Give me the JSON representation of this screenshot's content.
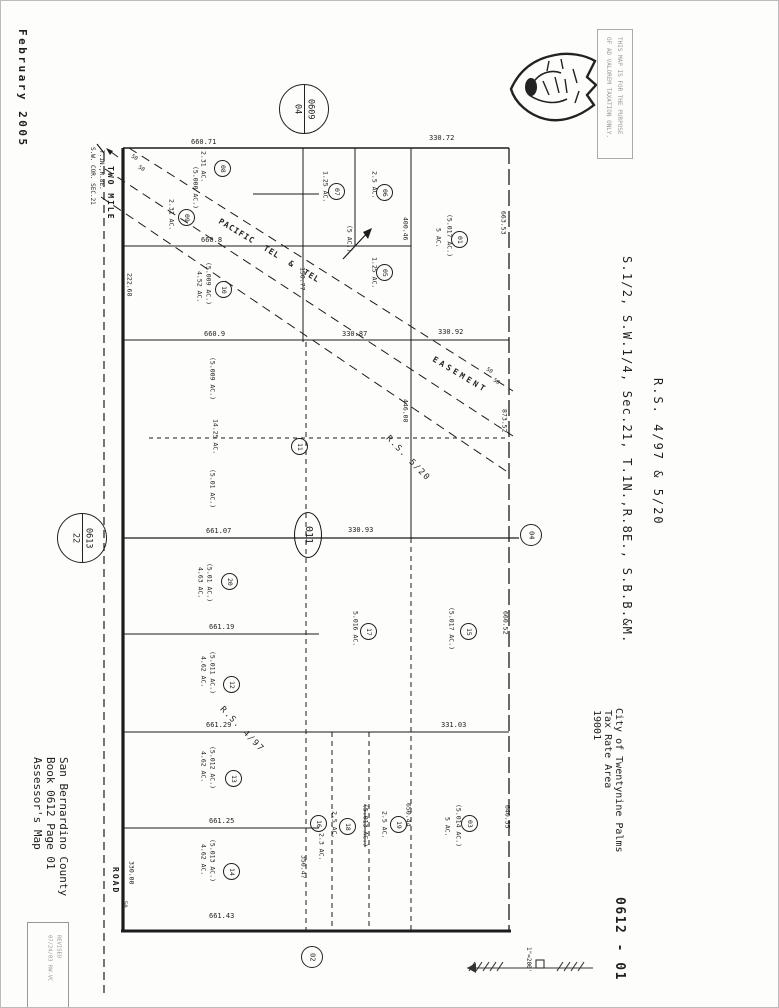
{
  "meta": {
    "date_stamp": "February 2005",
    "map_number": "0612 - 01",
    "scale": "1\"=200'",
    "seal_icon": "county-arrowhead-seal"
  },
  "disclaimer": {
    "lines": [
      "THIS MAP IS FOR THE PURPOSE",
      "OF AD VALOREM TAXATION ONLY."
    ]
  },
  "title": {
    "lines": [
      "S.1/2, S.W.1/4, Sec.21, T.1N.,R.8E., S.B.B.&M.",
      "R.S. 4/97 & 5/20"
    ]
  },
  "tax_area": {
    "lines": [
      "City of Twentynine Palms",
      "Tax Rate Area",
      "19001"
    ]
  },
  "assessor": {
    "lines": [
      "Assessor's Map",
      "Book 0612 Page 01",
      "San Bernardino County"
    ]
  },
  "revision": {
    "lines": [
      "REVISED",
      "07/24/03 RW-VC"
    ]
  },
  "corner": {
    "lines": [
      "S.W. COR. SEC.21",
      "T.1N.,R.8E."
    ]
  },
  "road": {
    "labels": [
      "TWO MILE",
      "ROAD"
    ]
  },
  "center_marker": {
    "text": "011"
  },
  "reference_circles": [
    {
      "lines": [
        "0609",
        "04"
      ],
      "x": 278,
      "y": 83,
      "d": 48,
      "divided": true,
      "name": "ref-circle-book-0609-page-04"
    },
    {
      "lines": [
        "0613",
        "22"
      ],
      "x": 56,
      "y": 512,
      "d": 48,
      "divided": true,
      "name": "ref-circle-book-0613-page-22"
    },
    {
      "lines": [
        "04"
      ],
      "x": 519,
      "y": 523,
      "d": 20,
      "divided": false,
      "name": "ref-circle-page-04"
    },
    {
      "lines": [
        "02"
      ],
      "x": 300,
      "y": 945,
      "d": 20,
      "divided": false,
      "name": "ref-circle-page-02"
    }
  ],
  "parcel_circles": [
    {
      "n": "08",
      "x": 221,
      "y": 167
    },
    {
      "n": "09",
      "x": 185,
      "y": 216
    },
    {
      "n": "07",
      "x": 335,
      "y": 190
    },
    {
      "n": "06",
      "x": 383,
      "y": 191
    },
    {
      "n": "05",
      "x": 383,
      "y": 271
    },
    {
      "n": "01",
      "x": 458,
      "y": 238
    },
    {
      "n": "10",
      "x": 222,
      "y": 288
    },
    {
      "n": "11",
      "x": 298,
      "y": 445
    },
    {
      "n": "20",
      "x": 228,
      "y": 580
    },
    {
      "n": "12",
      "x": 230,
      "y": 683
    },
    {
      "n": "13",
      "x": 232,
      "y": 777
    },
    {
      "n": "14",
      "x": 230,
      "y": 870
    },
    {
      "n": "17",
      "x": 367,
      "y": 630
    },
    {
      "n": "15",
      "x": 467,
      "y": 630
    },
    {
      "n": "16",
      "x": 317,
      "y": 822
    },
    {
      "n": "18",
      "x": 346,
      "y": 825
    },
    {
      "n": "19",
      "x": 397,
      "y": 823
    },
    {
      "n": "03",
      "x": 468,
      "y": 822
    }
  ],
  "map_annotations": [
    {
      "t": "660.71",
      "x": 190,
      "y": 138,
      "o": "h",
      "s": 7
    },
    {
      "t": "330.72",
      "x": 428,
      "y": 134,
      "o": "h",
      "s": 7
    },
    {
      "t": "660.8",
      "x": 200,
      "y": 236,
      "o": "h",
      "s": 7
    },
    {
      "t": "660.9",
      "x": 203,
      "y": 330,
      "o": "h",
      "s": 7
    },
    {
      "t": "330.87",
      "x": 341,
      "y": 330,
      "o": "h",
      "s": 7
    },
    {
      "t": "330.92",
      "x": 437,
      "y": 328,
      "o": "h",
      "s": 7
    },
    {
      "t": "661.07",
      "x": 205,
      "y": 527,
      "o": "h",
      "s": 7
    },
    {
      "t": "330.93",
      "x": 347,
      "y": 526,
      "o": "h",
      "s": 7
    },
    {
      "t": "661.19",
      "x": 208,
      "y": 623,
      "o": "h",
      "s": 7
    },
    {
      "t": "661.29",
      "x": 205,
      "y": 721,
      "o": "h",
      "s": 7
    },
    {
      "t": "331.03",
      "x": 440,
      "y": 721,
      "o": "h",
      "s": 7
    },
    {
      "t": "661.25",
      "x": 208,
      "y": 817,
      "o": "h",
      "s": 7
    },
    {
      "t": "661.43",
      "x": 208,
      "y": 912,
      "o": "h",
      "s": 7
    },
    {
      "t": "222.68",
      "x": 125,
      "y": 272,
      "o": "v",
      "s": 6.5
    },
    {
      "t": "150.77",
      "x": 298,
      "y": 266,
      "o": "v",
      "s": 6.5
    },
    {
      "t": "400.46",
      "x": 401,
      "y": 216,
      "o": "v",
      "s": 6.5
    },
    {
      "t": "446.08",
      "x": 401,
      "y": 398,
      "o": "v",
      "s": 6.5
    },
    {
      "t": "663.53",
      "x": 499,
      "y": 210,
      "o": "v",
      "s": 6.5
    },
    {
      "t": "873.52",
      "x": 500,
      "y": 408,
      "o": "v",
      "s": 6.5
    },
    {
      "t": "660.52",
      "x": 501,
      "y": 610,
      "o": "v",
      "s": 6.5
    },
    {
      "t": "640.55",
      "x": 503,
      "y": 804,
      "o": "v",
      "s": 6.5
    },
    {
      "t": "650.44",
      "x": 404,
      "y": 802,
      "o": "v",
      "s": 6.5
    },
    {
      "t": "350.47",
      "x": 299,
      "y": 854,
      "o": "v",
      "s": 6.5
    },
    {
      "t": "330.00",
      "x": 127,
      "y": 860,
      "o": "v",
      "s": 6.5
    },
    {
      "t": "50",
      "x": 120,
      "y": 900,
      "o": "v",
      "s": 5.5
    },
    {
      "t": "2.31 AC.",
      "x": 199,
      "y": 150,
      "o": "v",
      "s": 6.5
    },
    {
      "t": "(5.000 AC.)",
      "x": 191,
      "y": 165,
      "o": "v",
      "s": 6.5
    },
    {
      "t": "2.31 AC.",
      "x": 167,
      "y": 198,
      "o": "v",
      "s": 6.5
    },
    {
      "t": "1.25 AC.",
      "x": 321,
      "y": 170,
      "o": "v",
      "s": 6.5
    },
    {
      "t": "2.5 AC.",
      "x": 370,
      "y": 170,
      "o": "v",
      "s": 6.5
    },
    {
      "t": "1.25 AC.",
      "x": 370,
      "y": 256,
      "o": "v",
      "s": 6.5
    },
    {
      "t": "(5.017 AC.)",
      "x": 445,
      "y": 213,
      "o": "v",
      "s": 6.5
    },
    {
      "t": "5 AC.",
      "x": 434,
      "y": 227,
      "o": "v",
      "s": 6.5
    },
    {
      "t": "(5.009 AC.)",
      "x": 204,
      "y": 261,
      "o": "v",
      "s": 6.5
    },
    {
      "t": "4.52 AC.",
      "x": 195,
      "y": 270,
      "o": "v",
      "s": 6.5
    },
    {
      "t": "(5.009 AC.)",
      "x": 208,
      "y": 356,
      "o": "v",
      "s": 6.5
    },
    {
      "t": "14.25 AC.",
      "x": 211,
      "y": 418,
      "o": "v",
      "s": 6.5
    },
    {
      "t": "(5.01 AC.)",
      "x": 208,
      "y": 468,
      "o": "v",
      "s": 6.5
    },
    {
      "t": "(5.01 AC.)",
      "x": 205,
      "y": 562,
      "o": "v",
      "s": 6.5
    },
    {
      "t": "4.63 AC.",
      "x": 196,
      "y": 566,
      "o": "v",
      "s": 6.5
    },
    {
      "t": "(5.011 AC.)",
      "x": 208,
      "y": 650,
      "o": "v",
      "s": 6.5
    },
    {
      "t": "4.62 AC.",
      "x": 199,
      "y": 655,
      "o": "v",
      "s": 6.5
    },
    {
      "t": "(5.012 AC.)",
      "x": 208,
      "y": 745,
      "o": "v",
      "s": 6.5
    },
    {
      "t": "4.62 AC.",
      "x": 199,
      "y": 750,
      "o": "v",
      "s": 6.5
    },
    {
      "t": "(5.013 AC.)",
      "x": 208,
      "y": 838,
      "o": "v",
      "s": 6.5
    },
    {
      "t": "4.62 AC.",
      "x": 199,
      "y": 843,
      "o": "v",
      "s": 6.5
    },
    {
      "t": "5.016 AC.",
      "x": 351,
      "y": 610,
      "o": "v",
      "s": 6.5
    },
    {
      "t": "(5.017 AC.)",
      "x": 447,
      "y": 606,
      "o": "v",
      "s": 6.5
    },
    {
      "t": "2.3 AC.",
      "x": 317,
      "y": 832,
      "o": "v",
      "s": 6.5
    },
    {
      "t": "2.5 AC.",
      "x": 330,
      "y": 810,
      "o": "v",
      "s": 6.5
    },
    {
      "t": "2.5 AC.",
      "x": 380,
      "y": 810,
      "o": "v",
      "s": 6.5
    },
    {
      "t": "(5.013 AC.)",
      "x": 361,
      "y": 803,
      "o": "v",
      "s": 6.5,
      "strike": true
    },
    {
      "t": "(5.014 AC.)",
      "x": 454,
      "y": 803,
      "o": "v",
      "s": 6.5
    },
    {
      "t": "5 AC.",
      "x": 443,
      "y": 816,
      "o": "v",
      "s": 6.5
    },
    {
      "t": "(5 AC.)",
      "x": 345,
      "y": 224,
      "o": "v",
      "s": 6.5
    },
    {
      "t": "PACIFIC  TEL  &  TEL",
      "x": 218,
      "y": 216,
      "o": 31,
      "s": 8,
      "ls": 1,
      "b": true
    },
    {
      "t": "EASEMENT",
      "x": 432,
      "y": 354,
      "o": 31,
      "s": 8,
      "ls": 3,
      "b": true
    },
    {
      "t": "R.S. 5/20",
      "x": 386,
      "y": 432,
      "o": 46,
      "s": 8.5,
      "ls": 1.5
    },
    {
      "t": "R.S. 4/97",
      "x": 220,
      "y": 703,
      "o": 46,
      "s": 8.5,
      "ls": 1.5
    },
    {
      "t": "50",
      "x": 130,
      "y": 153,
      "o": 33,
      "s": 5.5
    },
    {
      "t": "50",
      "x": 137,
      "y": 164,
      "o": 33,
      "s": 5.5
    },
    {
      "t": "50",
      "x": 485,
      "y": 366,
      "o": 33,
      "s": 5.5
    },
    {
      "t": "50",
      "x": 492,
      "y": 377,
      "o": 33,
      "s": 5.5
    }
  ]
}
